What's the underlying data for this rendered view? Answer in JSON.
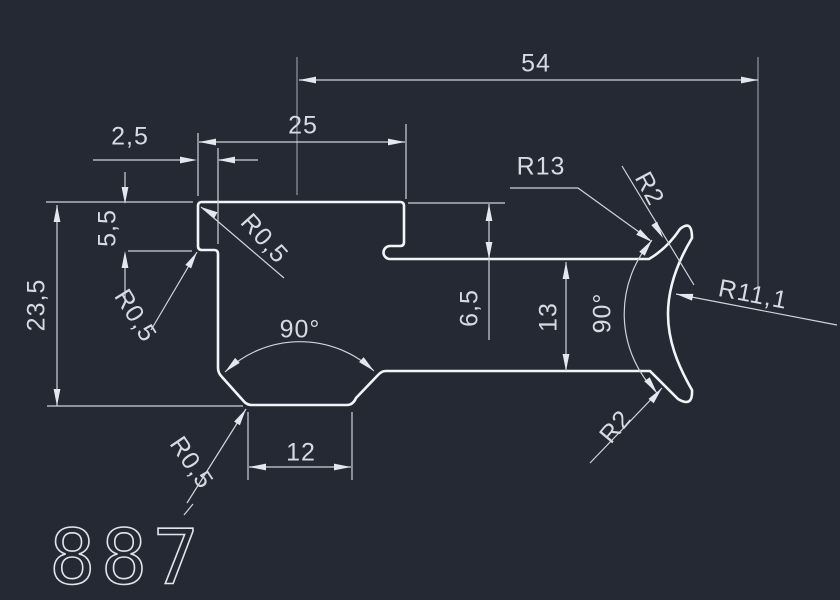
{
  "drawing": {
    "part_number": "887",
    "dimensions": {
      "overall_width": "54",
      "flange_width": "25",
      "step_width": "2,5",
      "step_depth": "5,5",
      "overall_height": "23,5",
      "slot_depth": "6,5",
      "arm_thickness": "13",
      "flat_width": "12",
      "v_angle": "90°",
      "arc_angle": "90°"
    },
    "radii": {
      "corner_top_left": "R0,5",
      "corner_step": "R0,5",
      "corner_bottom": "R0,5",
      "outer_arc": "R13",
      "tip_top": "R2",
      "inner_arc": "R11,1",
      "tip_bottom": "R2"
    },
    "colors": {
      "background": "#242933",
      "profile_line": "#f2f4f7",
      "dimension_line": "#cfd4db",
      "text": "#d6dae2"
    }
  }
}
